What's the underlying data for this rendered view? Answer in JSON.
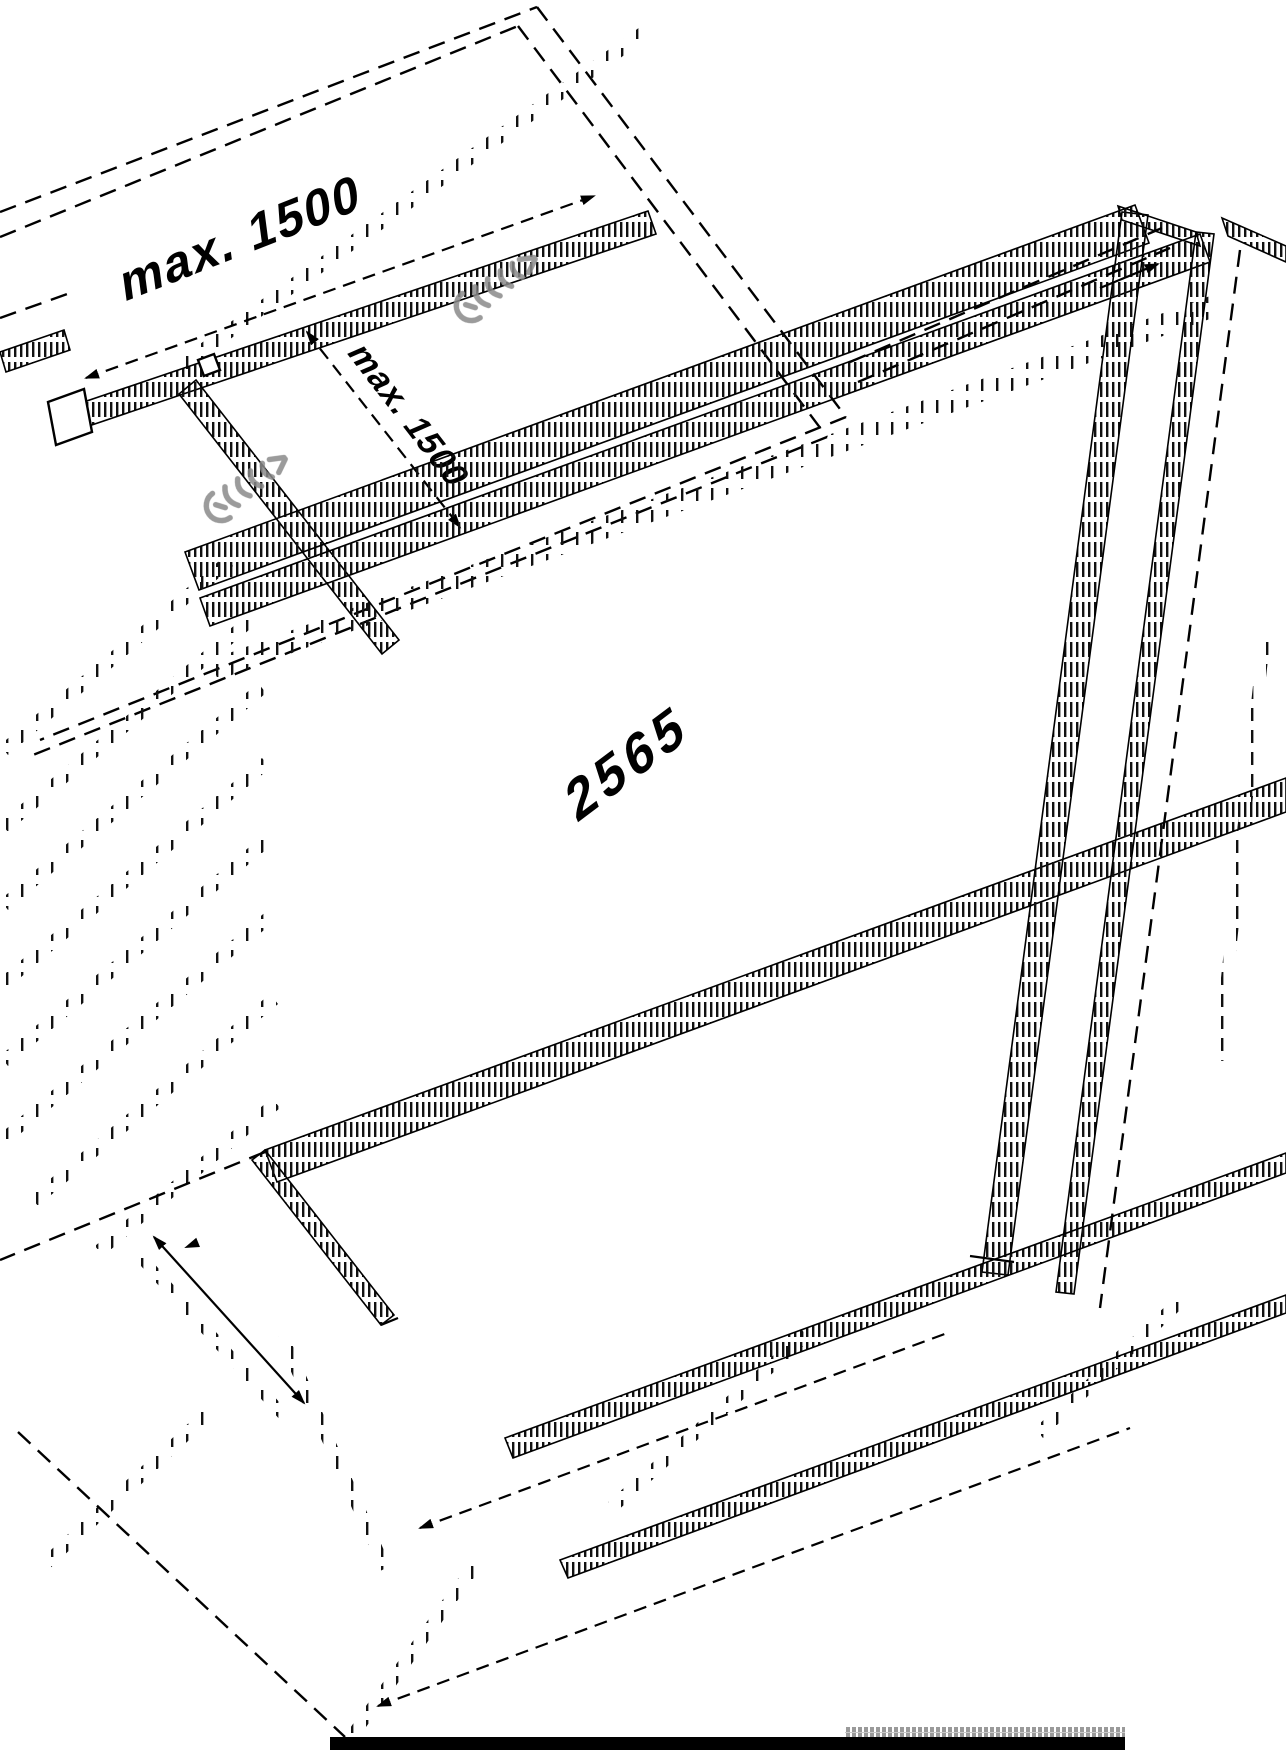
{
  "drawing": {
    "title": "isometric-assembly-diagram",
    "labels": {
      "dim_top": "max. 1500",
      "dim_side": "max. 1500",
      "dim_length": "2565"
    },
    "icons": [
      "screw-icon",
      "arrowhead-icon"
    ],
    "colors": {
      "line": "#000000",
      "screw_gray": "#8a8a8a",
      "background": "#ffffff",
      "bottom_bar": "#000000",
      "bottom_strip": "#9a9a9a"
    }
  }
}
